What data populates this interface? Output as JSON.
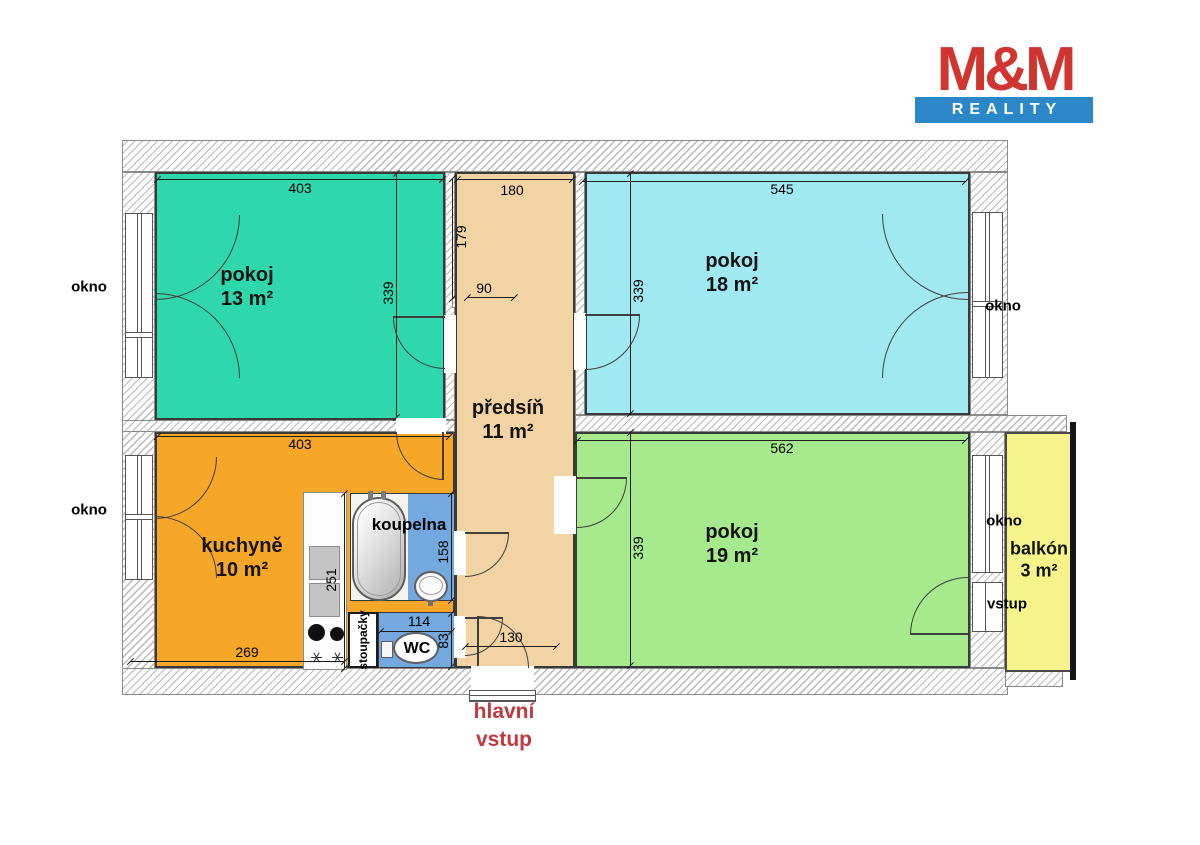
{
  "logo": {
    "name": "M&M",
    "tagline": "REALITY"
  },
  "rooms": {
    "pokoj13": {
      "name": "pokoj",
      "area": "13 m²"
    },
    "pokoj18": {
      "name": "pokoj",
      "area": "18 m²"
    },
    "pokoj19": {
      "name": "pokoj",
      "area": "19 m²"
    },
    "kuchyne": {
      "name": "kuchyně",
      "area": "10 m²"
    },
    "predsin": {
      "name": "předsíň",
      "area": "11 m²"
    },
    "koupelna": {
      "name": "koupelna"
    },
    "wc": {
      "name": "WC"
    },
    "stoupacky": {
      "name": "stoupačky"
    },
    "balkon": {
      "name": "balkón",
      "area": "3 m²"
    }
  },
  "labels": {
    "okno": "okno",
    "vstup": "vstup",
    "entrance_line1": "hlavní",
    "entrance_line2": "vstup"
  },
  "dims": {
    "d403": "403",
    "d180": "180",
    "d545": "545",
    "d339": "339",
    "d179": "179",
    "d90": "90",
    "d562": "562",
    "d269": "269",
    "d251": "251",
    "d158": "158",
    "d114": "114",
    "d83": "83",
    "d130": "130"
  },
  "colors": {
    "room_teal": "#2fd7ac",
    "room_cyan": "#a0e9f1",
    "room_green": "#a6ea8d",
    "kitchen_orange": "#f6a727",
    "hallway_peach": "#f2d3a4",
    "bathroom_blue": "#74a9df",
    "balcony_yellow": "#f5f38a",
    "wall_hatch_line": "#b8b8b8",
    "logo_red": "#d0352f",
    "logo_blue": "#2b87c8",
    "entrance_text": "#c2383e"
  }
}
